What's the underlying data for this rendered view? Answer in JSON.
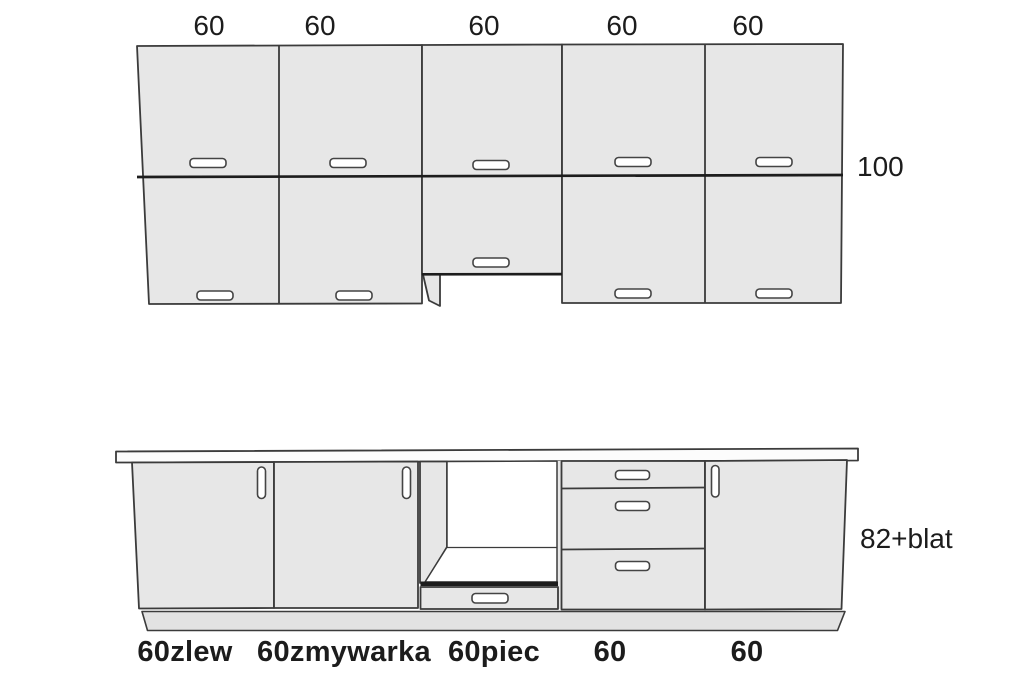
{
  "diagram": {
    "upper_cabinets": {
      "width_labels": [
        "60",
        "60",
        "60",
        "60",
        "60"
      ],
      "height_label": "100"
    },
    "lower_cabinets": {
      "height_label": "82+blat",
      "unit_labels": [
        "60zlew",
        "60zmywarka",
        "60piec",
        "60",
        "60"
      ]
    }
  },
  "colors": {
    "background": "#ffffff",
    "cabinet_fill": "#e7e7e7",
    "plinth_fill": "#e2e2e2",
    "countertop_fill": "#fcfcfc",
    "line": "#3b3b3b",
    "line_strong": "#1d1d1d",
    "handle_fill": "#ffffff",
    "text": "#1c1c1c"
  }
}
